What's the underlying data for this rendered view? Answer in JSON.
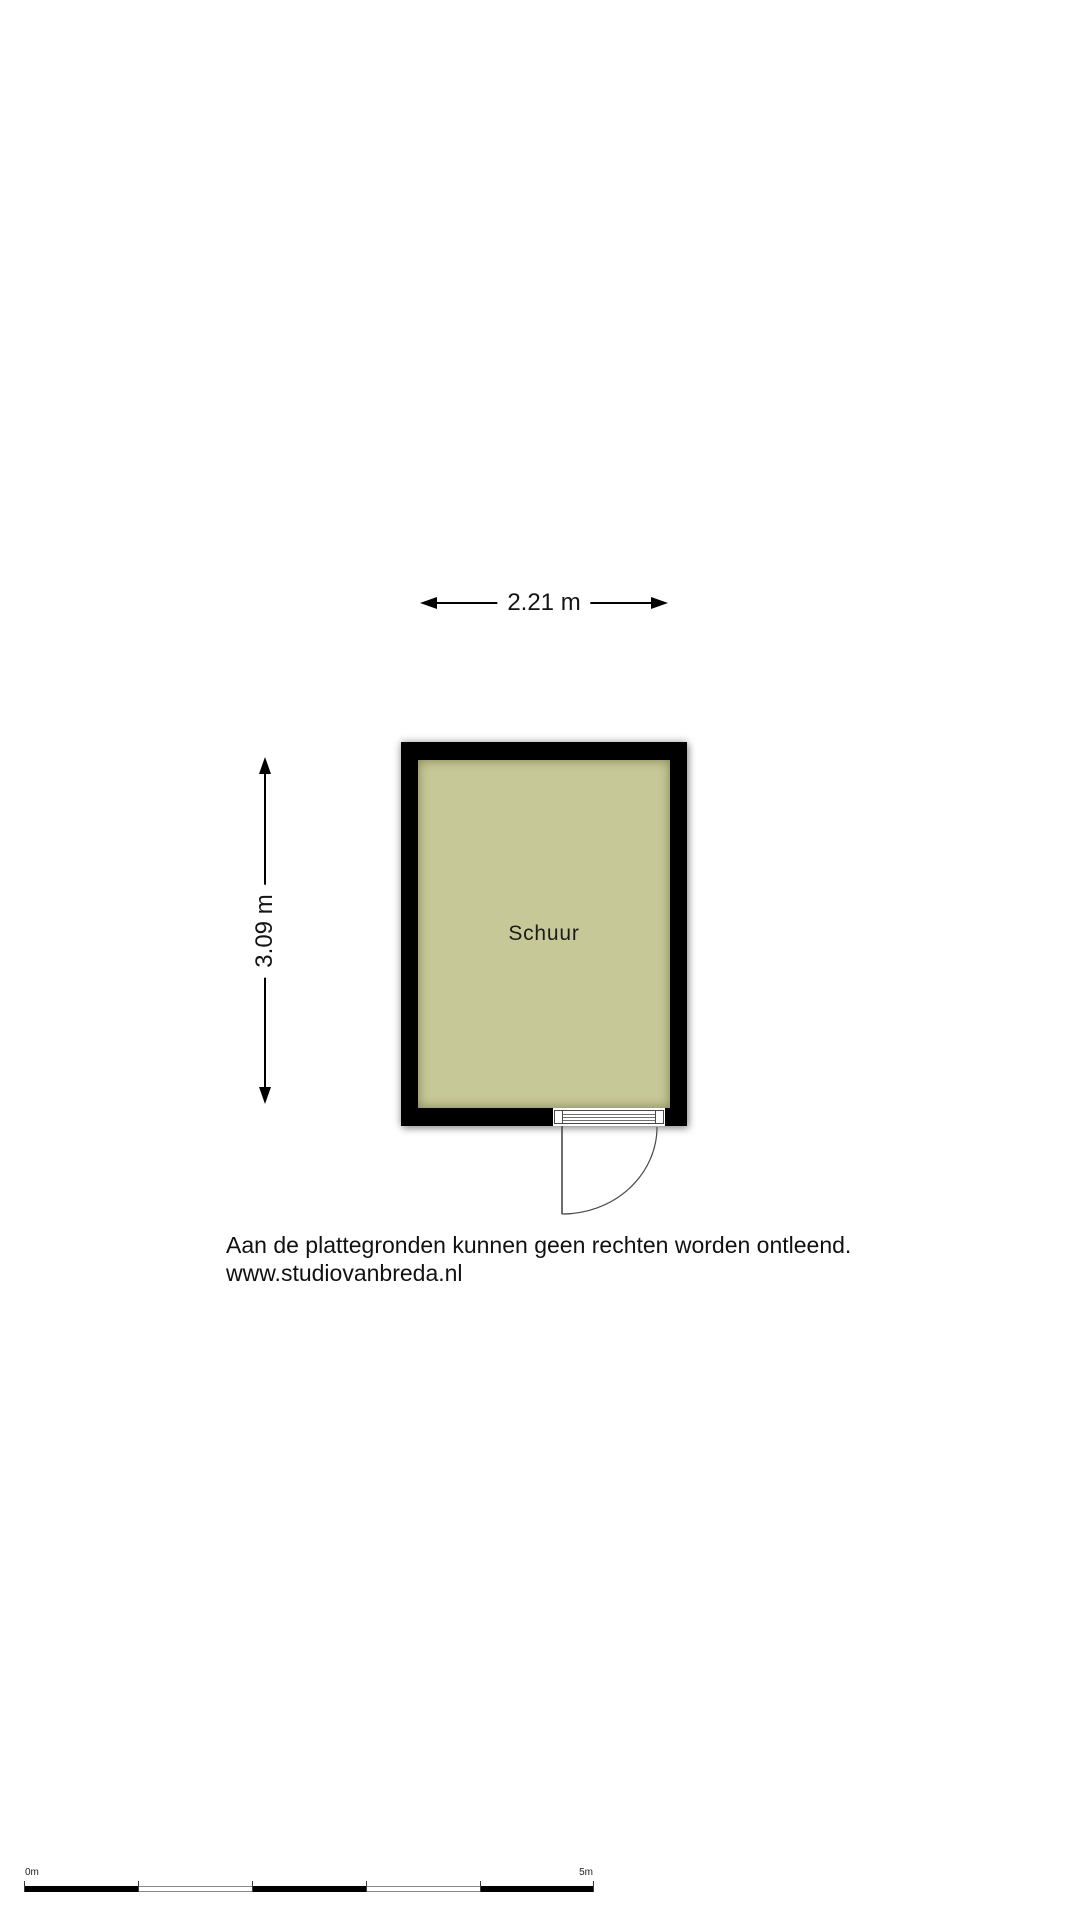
{
  "floorplan": {
    "room": {
      "label": "Schuur",
      "floor_color": "#c7c897",
      "wall_color": "#000000"
    },
    "dimensions": {
      "width_label": "2.21 m",
      "height_label": "3.09 m"
    }
  },
  "disclaimer": {
    "line1": "Aan de plattegronden kunnen geen rechten worden ontleend.",
    "line2": "www.studiovanbreda.nl"
  },
  "scale_bar": {
    "start_label": "0m",
    "end_label": "5m",
    "segments": 5,
    "segment_colors": [
      "#000000",
      "#ffffff",
      "#000000",
      "#ffffff",
      "#000000"
    ]
  }
}
